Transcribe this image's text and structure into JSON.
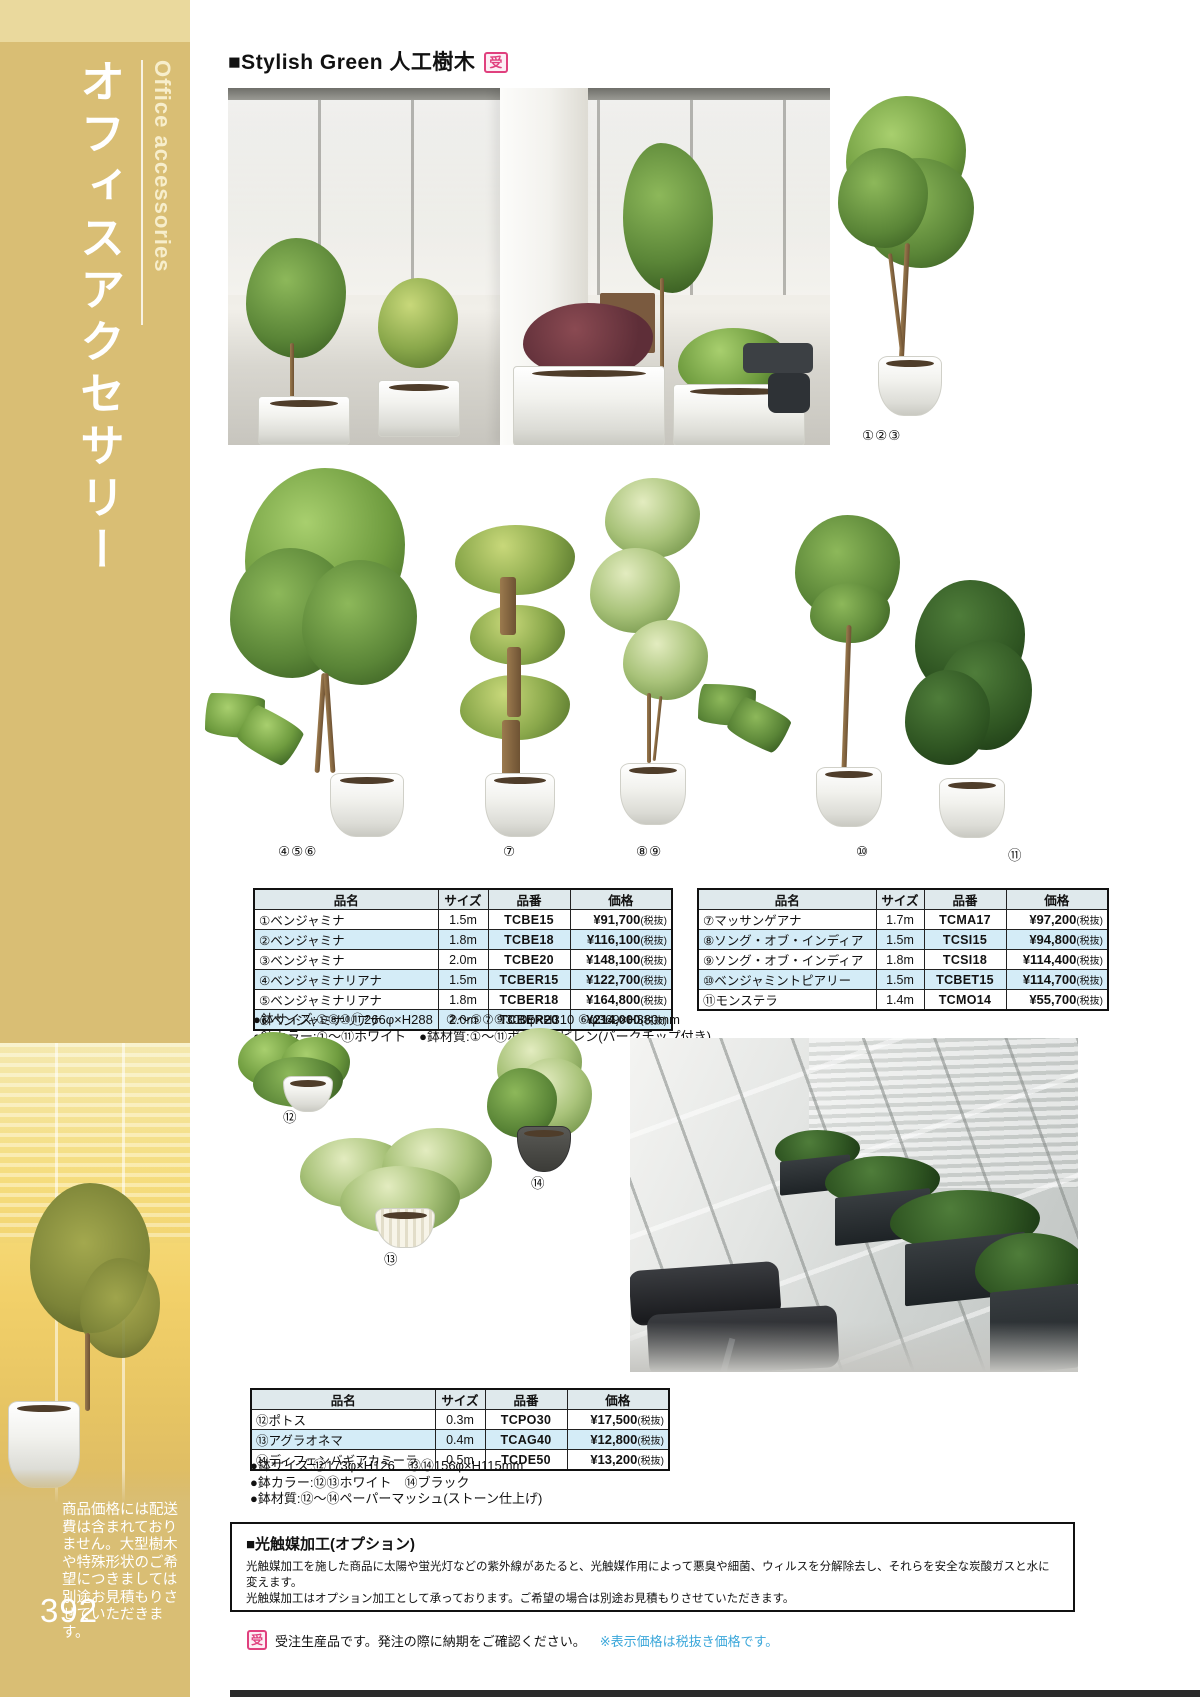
{
  "sidebar": {
    "title": "オフィスアクセサリー",
    "subtitle": "Office accessories",
    "note": "商品価格には配送費は含まれておりません。大型樹木や特殊形状のご希望につきましては別途お見積もりさせていただきます。",
    "page_number": "392"
  },
  "header": {
    "title": "■Stylish Green 人工樹木",
    "badge": "受"
  },
  "labels": {
    "top_tree": "①②③",
    "ficus_liana": "④⑤⑥",
    "massangeana": "⑦",
    "song_of_india": "⑧⑨",
    "topiary": "⑩",
    "monstera": "⑪",
    "pothos": "⑫",
    "aglaonema": "⑬",
    "dieffenbachia": "⑭"
  },
  "tables": {
    "headers": {
      "name": "品名",
      "size": "サイズ",
      "code": "品番",
      "price": "価格"
    },
    "left": {
      "rows": [
        {
          "name": "①ベンジャミナ",
          "size": "1.5m",
          "code": "TCBE15",
          "price": "¥91,700",
          "tax": "(税抜)"
        },
        {
          "name": "②ベンジャミナ",
          "size": "1.8m",
          "code": "TCBE18",
          "price": "¥116,100",
          "tax": "(税抜)"
        },
        {
          "name": "③ベンジャミナ",
          "size": "2.0m",
          "code": "TCBE20",
          "price": "¥148,100",
          "tax": "(税抜)"
        },
        {
          "name": "④ベンジャミナリアナ",
          "size": "1.5m",
          "code": "TCBER15",
          "price": "¥122,700",
          "tax": "(税抜)"
        },
        {
          "name": "⑤ベンジャミナリアナ",
          "size": "1.8m",
          "code": "TCBER18",
          "price": "¥164,800",
          "tax": "(税抜)"
        },
        {
          "name": "⑥ベンジャミナリアナ",
          "size": "2.0m",
          "code": "TCBER20",
          "price": "¥214,000",
          "tax": "(税抜)"
        }
      ],
      "notes": [
        "●鉢サイズ:①⑧⑩⑪266φ×H288　②～⑤⑦⑨300φ×H310 ⑥φ369×H380mm",
        "●鉢カラー:①～⑪ホワイト　●鉢材質:①～⑪ポリプロピレン(バークチップ付き)"
      ]
    },
    "right": {
      "rows": [
        {
          "name": "⑦マッサンゲアナ",
          "size": "1.7m",
          "code": "TCMA17",
          "price": "¥97,200",
          "tax": "(税抜)"
        },
        {
          "name": "⑧ソング・オブ・インディア",
          "size": "1.5m",
          "code": "TCSI15",
          "price": "¥94,800",
          "tax": "(税抜)"
        },
        {
          "name": "⑨ソング・オブ・インディア",
          "size": "1.8m",
          "code": "TCSI18",
          "price": "¥114,400",
          "tax": "(税抜)"
        },
        {
          "name": "⑩ベンジャミントピアリー",
          "size": "1.5m",
          "code": "TCBET15",
          "price": "¥114,700",
          "tax": "(税抜)"
        },
        {
          "name": "⑪モンステラ",
          "size": "1.4m",
          "code": "TCMO14",
          "price": "¥55,700",
          "tax": "(税抜)"
        }
      ]
    },
    "bottom": {
      "rows": [
        {
          "name": "⑫ポトス",
          "size": "0.3m",
          "code": "TCPO30",
          "price": "¥17,500",
          "tax": "(税抜)"
        },
        {
          "name": "⑬アグラオネマ",
          "size": "0.4m",
          "code": "TCAG40",
          "price": "¥12,800",
          "tax": "(税抜)"
        },
        {
          "name": "⑭ディフェンバギアカミーラ",
          "size": "0.5m",
          "code": "TCDE50",
          "price": "¥13,200",
          "tax": "(税抜)"
        }
      ],
      "notes": [
        "●鉢サイズ:⑫173φ×H126　⑬⑭156φ×H115mm",
        "●鉢カラー:⑫⑬ホワイト　⑭ブラック",
        "●鉢材質:⑫～⑭ペーパーマッシュ(ストーン仕上げ)"
      ]
    }
  },
  "option_box": {
    "title": "■光触媒加工(オプション)",
    "line1": "光触媒加工を施した商品に太陽や蛍光灯などの紫外線があたると、光触媒作用によって悪臭や細菌、ウィルスを分解除去し、それらを安全な炭酸ガスと水に変えます。",
    "line2": "光触媒加工はオプション加工として承っております。ご希望の場合は別途お見積もりさせていただきます。"
  },
  "footer": {
    "badge": "受",
    "note": "受注生産品です。発注の際に納期をご確認ください。",
    "tax_note": "※表示価格は税抜き価格です。"
  },
  "colors": {
    "sidebar_gold": "#d9be74",
    "accent_pink": "#e0407e",
    "note_blue": "#3ba7da",
    "row_alt_blue": "#d4ecf7",
    "table_header": "#dfe9ec"
  }
}
